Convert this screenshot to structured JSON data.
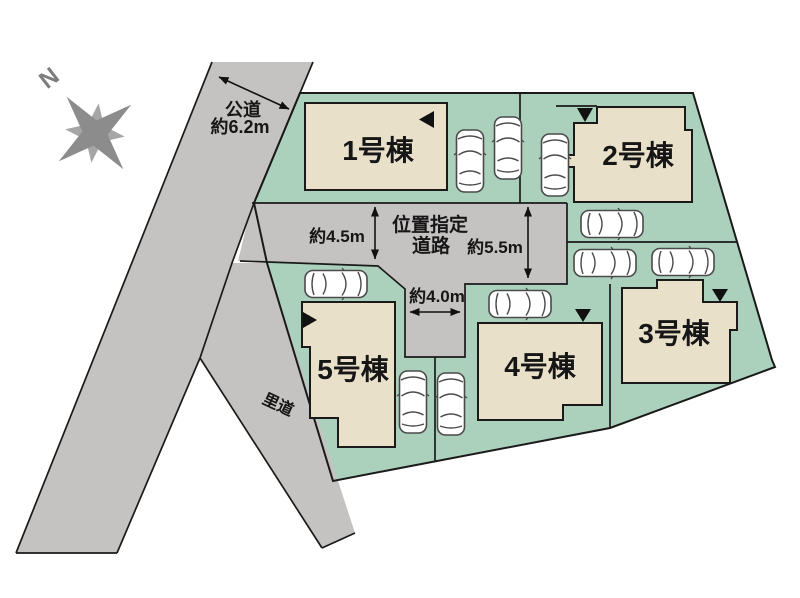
{
  "colors": {
    "site_green": "#abd1bc",
    "building_beige": "#e9e0ca",
    "road_gray": "#c5c3c2",
    "outline_black": "#1a1a1a"
  },
  "compass": {
    "north_label": "N"
  },
  "roads": {
    "public_road": {
      "name": "公道",
      "width_label": "約6.2m"
    },
    "village_road": {
      "name": "里道"
    },
    "designated_road": {
      "name_line1": "位置指定",
      "name_line2": "道路",
      "width_left_label": "約4.5m",
      "width_right_label": "約5.5m",
      "width_branch_label": "約4.0m"
    }
  },
  "buildings": [
    {
      "label": "1号棟"
    },
    {
      "label": "2号棟"
    },
    {
      "label": "3号棟"
    },
    {
      "label": "4号棟"
    },
    {
      "label": "5号棟"
    }
  ]
}
